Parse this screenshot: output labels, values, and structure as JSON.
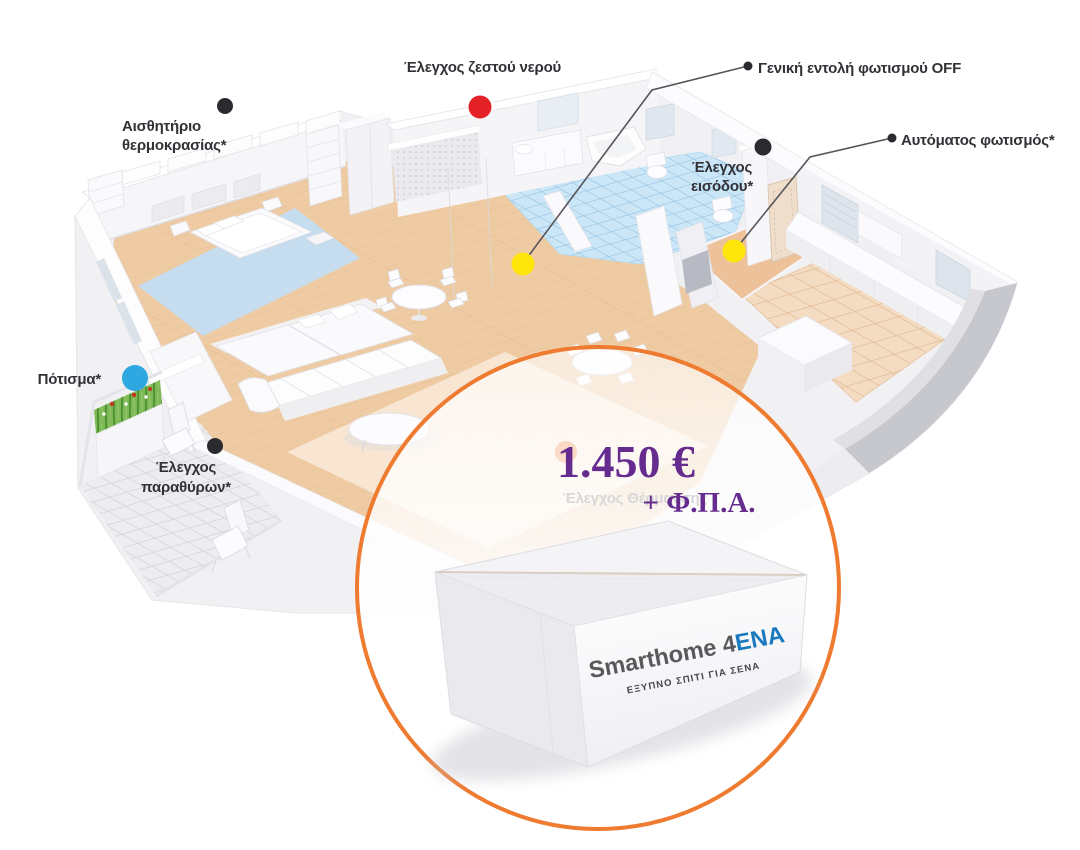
{
  "callouts": {
    "temperature_sensor": {
      "line1": "Αισθητήριο",
      "line2": "θερμοκρασίας*"
    },
    "hot_water": {
      "label": "Έλεγχος ζεστού νερού"
    },
    "lights_off": {
      "label": "Γενική εντολή φωτισμού OFF"
    },
    "entrance_control": {
      "line1": "Έλεγχος",
      "line2": "εισόδου*"
    },
    "auto_lighting": {
      "label": "Αυτόματος φωτισμός*"
    },
    "irrigation": {
      "label": "Πότισμα*"
    },
    "window_control": {
      "line1": "Έλεγχος",
      "line2": "παραθύρων*"
    },
    "heating_control": {
      "label": "Έλεγχος Θέρμανσης"
    }
  },
  "offer": {
    "price": "1.450 €",
    "vat_note": "+ Φ.Π.Α."
  },
  "product_box": {
    "brand": "Smarthome 4",
    "brand_suffix": "ENA",
    "tagline": "ΕΞΥΠΝΟ ΣΠΙΤΙ ΓΙΑ ΣΕΝΑ"
  },
  "colors": {
    "dot_black": "#2B2A2E",
    "dot_red": "#E42127",
    "dot_yellow": "#FFE60A",
    "dot_blue": "#2FA8E1",
    "dot_heating_orange": "#EE7A2E",
    "circle_orange": "#EE7B30",
    "price_purple": "#662B8F",
    "brand_gray": "#58595B",
    "brand_blue": "#1879BF"
  }
}
